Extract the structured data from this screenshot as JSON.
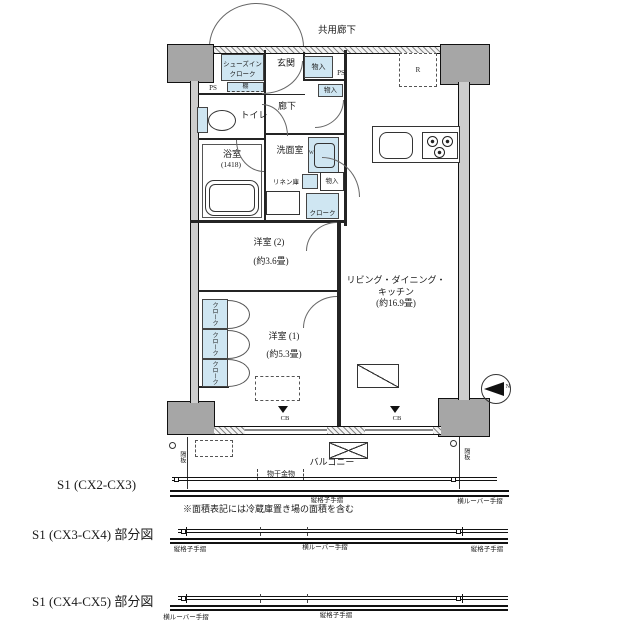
{
  "colors": {
    "fill_blue": "#cfe6f2",
    "column_gray": "#a6a6a6",
    "line": "#1b1b1b"
  },
  "plan": {
    "corridor": "共用廊下",
    "entrance": "玄関",
    "shoes_cloak_line1": "シューズイン",
    "shoes_cloak_line2": "クローク",
    "shelf": "棚",
    "ps_left": "PS",
    "ps_right": "PS",
    "storage_entry": "物入",
    "storage_hall": "物入",
    "hallway": "廊下",
    "toilet": "トイレ",
    "bath": "浴室",
    "bath_size": "(1418)",
    "washroom": "洗面室",
    "linen": "リネン庫",
    "storage_wash": "物入",
    "cloak_hall": "クローク",
    "fridge_mark": "R",
    "washer_mark": "W",
    "room2": "洋室 (2)",
    "room2_area": "(約3.6畳)",
    "room1": "洋室 (1)",
    "room1_area": "(約5.3畳)",
    "ldk_line1": "リビング・ダイニング・",
    "ldk_line2": "キッチン",
    "ldk_area": "(約16.9畳)",
    "closets": [
      "クローク",
      "クローク",
      "クローク"
    ],
    "cb_left": "CB",
    "cb_right": "CB",
    "compass_n": "N",
    "balcony": "バルコニー",
    "laundry_fitting": "物干金物",
    "divider_left": "隔板",
    "divider_right": "隔板"
  },
  "sections": [
    {
      "label": "S1 (CX2-CX3)",
      "rails": [
        "縦格子手摺",
        "横ルーバー手摺"
      ]
    },
    {
      "label": "S1 (CX3-CX4) 部分図",
      "rails": [
        "縦格子手摺",
        "横ルーバー手摺",
        "縦格子手摺"
      ]
    },
    {
      "label": "S1 (CX4-CX5) 部分図",
      "rails": [
        "横ルーバー手摺",
        "縦格子手摺"
      ]
    }
  ],
  "note": "※面積表記には冷蔵庫置き場の面積を含む"
}
